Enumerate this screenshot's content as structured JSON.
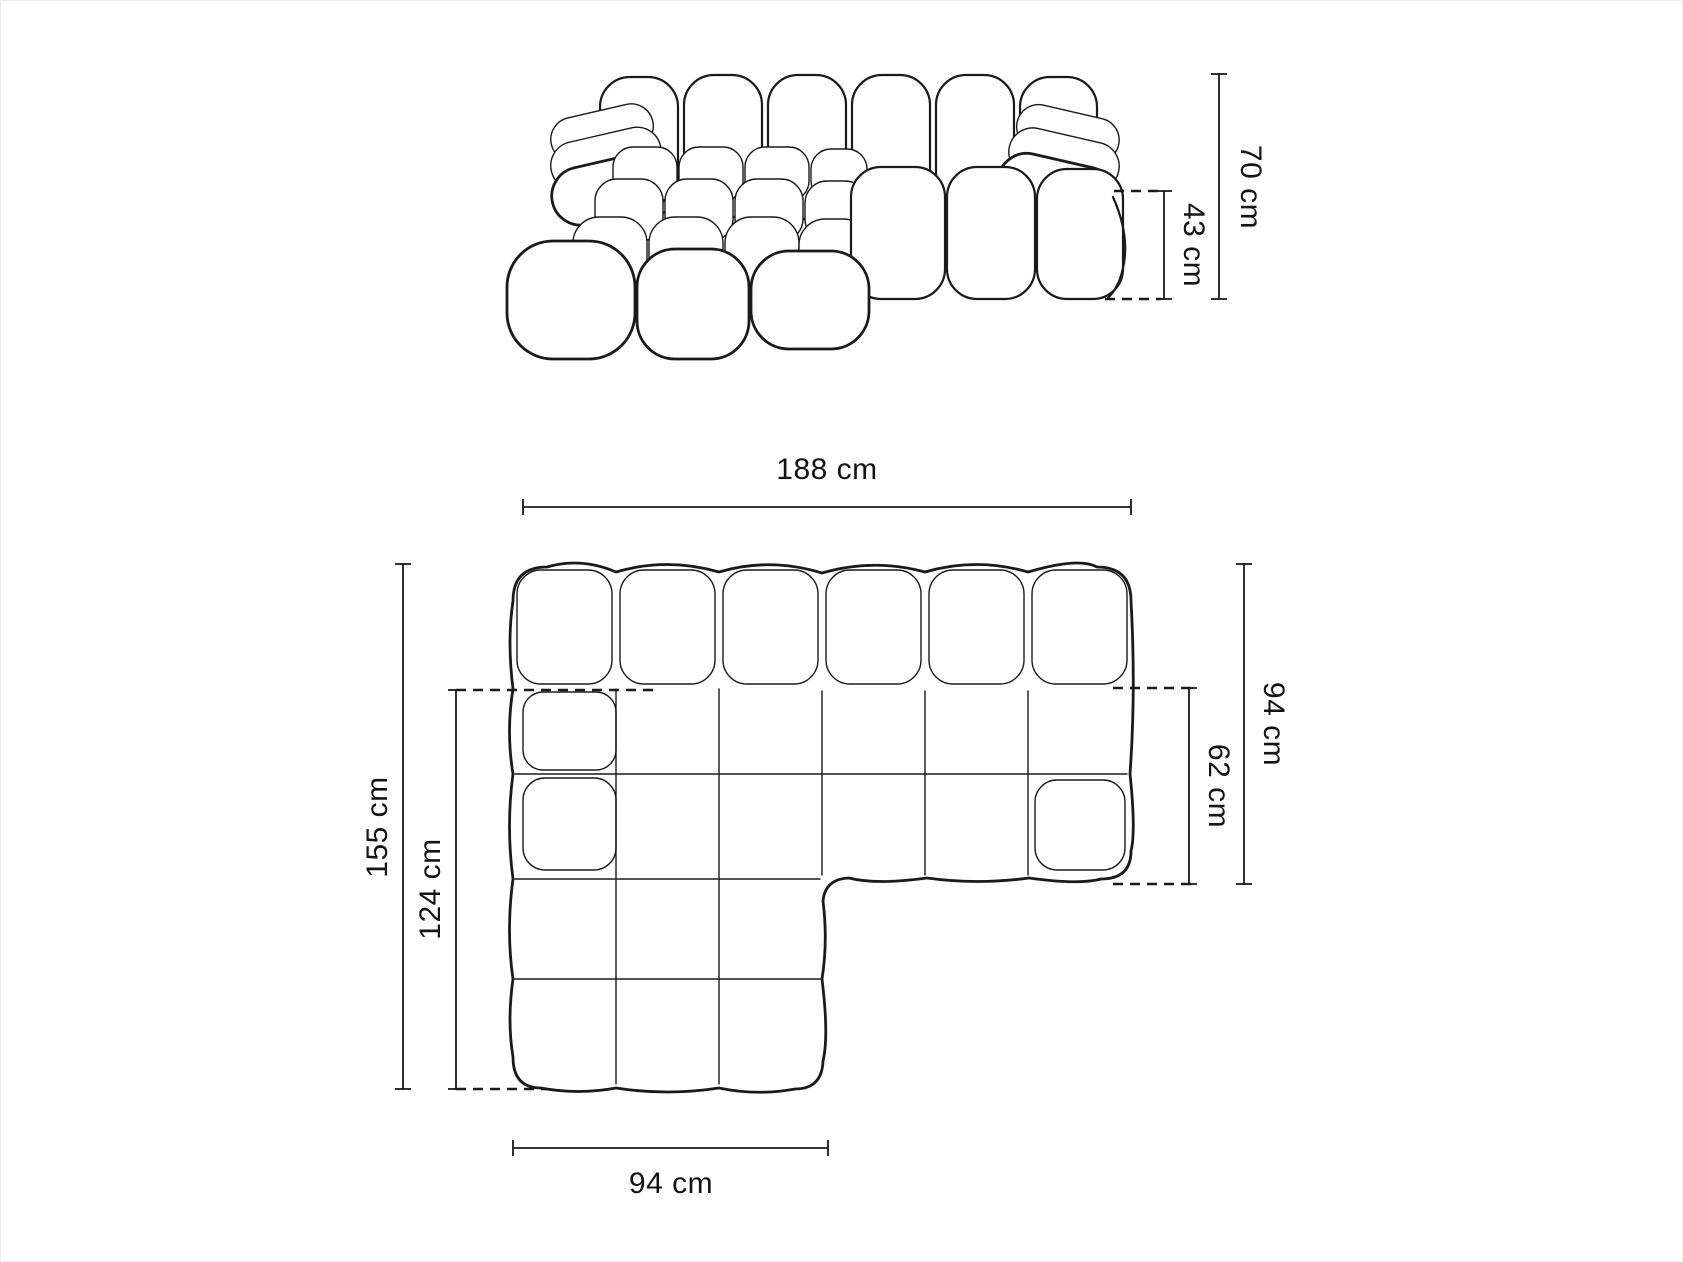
{
  "page": {
    "background": "#ffffff",
    "line_color": "#1a1a1a",
    "text_color": "#141414",
    "description": "Technical dimension drawing of a modular tufted corner sofa with chaise, side elevation view above and top plan view below"
  },
  "views": {
    "elevation": {
      "name": "side-elevation-view",
      "dims": {
        "total_height": "70 cm",
        "seat_height": "43 cm"
      }
    },
    "plan": {
      "name": "top-plan-view",
      "dims": {
        "total_width": "188 cm",
        "total_depth": "155 cm",
        "chaise_extension_depth": "124 cm",
        "right_section_depth": "94 cm",
        "seat_depth": "62 cm",
        "chaise_width": "94 cm"
      }
    }
  },
  "measurements": {
    "unit": "cm",
    "total_height": 70,
    "seat_height": 43,
    "total_width": 188,
    "total_depth": 155,
    "chaise_extension_depth": 124,
    "right_section_depth": 94,
    "seat_depth": 62,
    "chaise_width": 94
  }
}
